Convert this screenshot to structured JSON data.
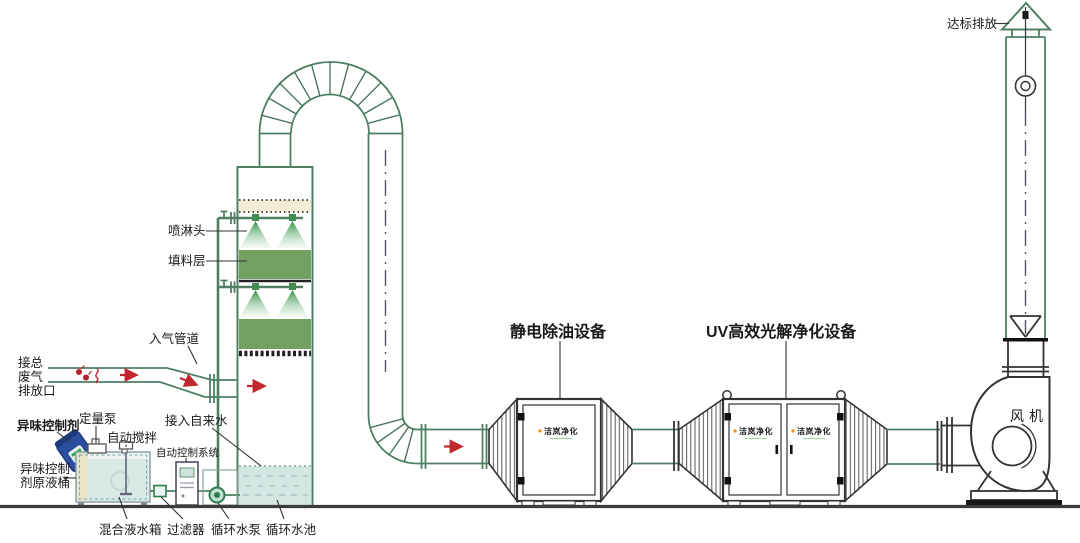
{
  "diagram_type": "waste-gas-treatment-process-flow",
  "colors": {
    "line_green": "#4e7f63",
    "dark_line": "#333333",
    "packing_green": "#71a061",
    "demister_beige": "#f2ecd6",
    "water_blue": "#d3e6e2",
    "tank_water": "#d8e9e6",
    "arrow_red": "#c1272d",
    "label_orange": "#f08c1e",
    "logo_green": "#2fa84f",
    "barrel_blue": "#2b4f9e"
  },
  "labels": {
    "emission": "达标排放",
    "inlet_pipe": "入气管道",
    "waste1": "接总",
    "waste2": "废气",
    "waste3": "排放口",
    "spray_head": "喷淋头",
    "packing": "填料层",
    "odor_agent": "异味控制剂",
    "metering_pump": "定量泵",
    "auto_stir": "自动搅拌",
    "tap_water": "接入自来水",
    "control_system": "自动控制系统",
    "barrel1": "异味控制",
    "barrel2": "剂原液桶",
    "mixing_tank": "混合液水箱",
    "filter": "过滤器",
    "circ_pump": "循环水泵",
    "circ_pool": "循环水池",
    "esp_title": "静电除油设备",
    "uv_title": "UV高效光解净化设备",
    "fan": "风机",
    "logo": "洁岚净化"
  }
}
